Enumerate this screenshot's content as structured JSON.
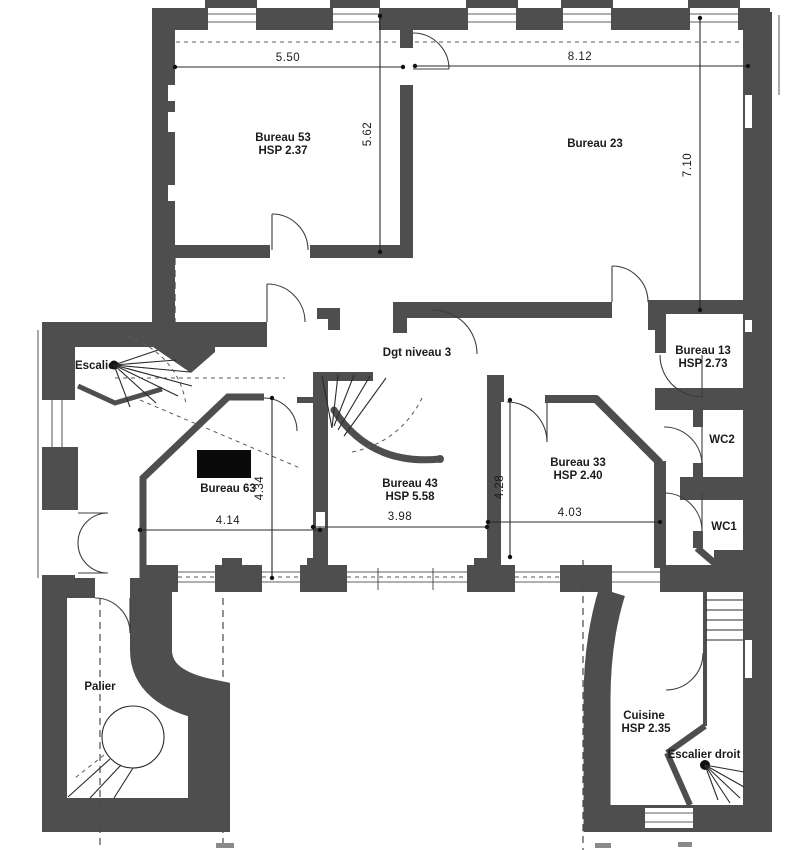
{
  "rooms": {
    "bureau53": {
      "name": "Bureau 53",
      "hsp": "HSP 2.37"
    },
    "bureau23": {
      "name": "Bureau 23"
    },
    "bureau13": {
      "name": "Bureau 13",
      "hsp": "HSP 2.73"
    },
    "bureau63": {
      "name": "Bureau 63"
    },
    "bureau43": {
      "name": "Bureau 43",
      "hsp": "HSP 5.58"
    },
    "bureau33": {
      "name": "Bureau 33",
      "hsp": "HSP 2.40"
    },
    "wc2": {
      "name": "WC2"
    },
    "wc1": {
      "name": "WC1"
    },
    "escalier": {
      "name": "Escalier"
    },
    "corridor": {
      "name": "Dgt niveau 3"
    },
    "palier": {
      "name": "Palier"
    },
    "cuisine": {
      "name": "Cuisine",
      "hsp": "HSP 2.35"
    },
    "escalier_droit": {
      "name": "Escalier droit"
    }
  },
  "dimensions": {
    "bureau53_width": "5.50",
    "bureau23_width": "8.12",
    "bureau53_height": "5.62",
    "bureau23_height": "7.10",
    "bureau63_height": "4.34",
    "bureau63_width": "4.14",
    "bureau43_width": "3.98",
    "bureau43_height": "4.28",
    "bureau33_width": "4.03"
  },
  "colors": {
    "wall": "#4e4e4e",
    "line": "#2a2a2a",
    "background": "#ffffff"
  }
}
